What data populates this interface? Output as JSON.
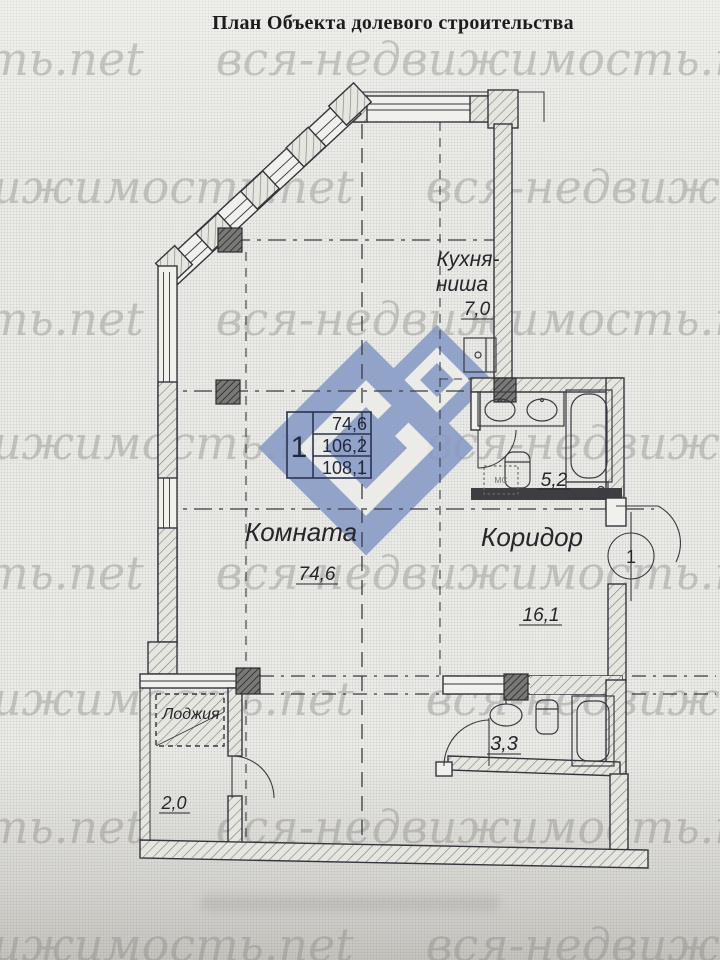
{
  "page": {
    "title": "План Объекта долевого строительства"
  },
  "watermark": {
    "text": "вся-недвижимость.net"
  },
  "apartment_table": {
    "number": "1",
    "rows": [
      "74,6",
      "106,2",
      "108,1"
    ]
  },
  "rooms": {
    "kitchen": {
      "name_line1": "Кухня-",
      "name_line2": "ниша",
      "area": "7,0"
    },
    "living_room": {
      "name": "Комната",
      "area": "74,6"
    },
    "corridor": {
      "name": "Коридор",
      "area": "16,1"
    },
    "bathroom": {
      "area": "5,2"
    },
    "wc": {
      "area": "3,3"
    },
    "loggia": {
      "name": "Лоджия",
      "area": "2,0"
    }
  },
  "fixtures": {
    "washing_machine_label": "МС"
  },
  "entrance": {
    "door_number": "1"
  },
  "colors": {
    "logo_blue": "#8598c6",
    "ink": "#35363c",
    "table_ink": "#23ig2b4a"
  }
}
